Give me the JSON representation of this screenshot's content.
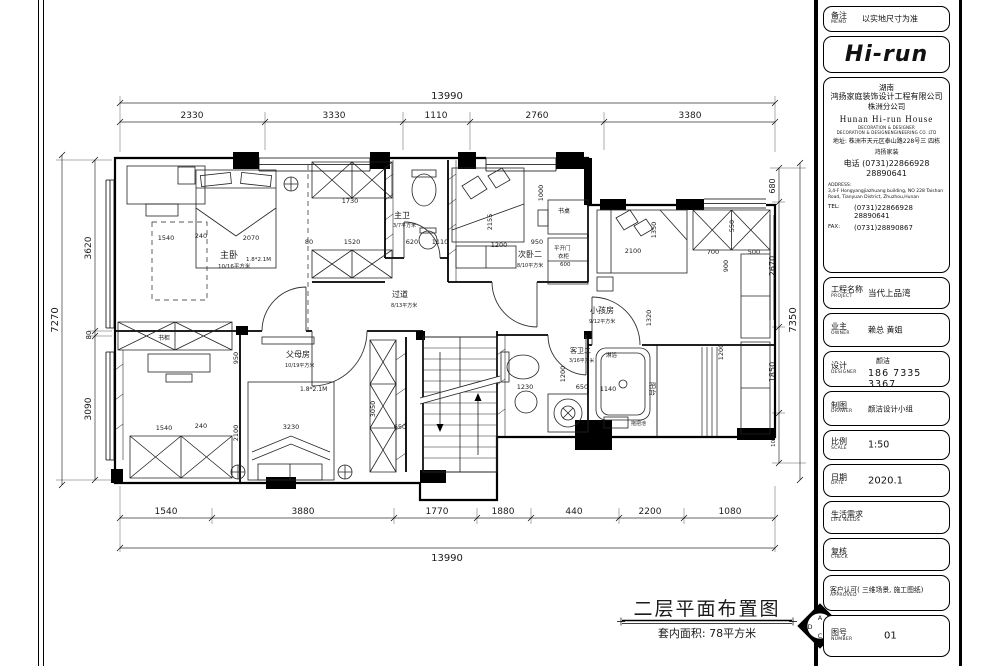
{
  "titleblock": {
    "memo": {
      "cn": "备注",
      "en": "MEMO",
      "value": "以实地尺寸为准"
    },
    "logo": "Hi-run",
    "company": {
      "region": "湖南",
      "name": "鸿扬家庭装饰设计工程有限公司",
      "branch": "株洲分公司",
      "en_name": "Hunan Hi-run House",
      "en_line1": "DECORATION & DESIGNER",
      "en_line2": "DECORATION & DESIGNENGINEERING CO. LTD",
      "addr": "地址: 株洲市天元区泰山路228号三 四栋",
      "addr2": "鸿扬家装",
      "phone": "电话  (0731)22866928",
      "phone2": "28890641",
      "en_addr_label": "ADDRESS:",
      "en_addr": "3,4-F Hongyangjiazhuang building, NO 228 Taishan Road, Tianyuan District, Zhuzhou,Hunan",
      "tel_label": "TEL:",
      "tel": "(0731)22866928\n28890641",
      "fax_label": "FAX:",
      "fax": "(0731)28890867"
    },
    "project": {
      "cn": "工程名称",
      "en": "PROJECT",
      "value": "当代上品湾"
    },
    "owner": {
      "cn": "业主",
      "en": "OWNER",
      "value": "赖总  黄姐"
    },
    "designer": {
      "cn": "设计",
      "en": "DESIGNER",
      "name": "颜洁",
      "phone": "186 7335 3367"
    },
    "drawer": {
      "cn": "制图",
      "en": "DRAWER",
      "value": "颜洁设计小组"
    },
    "scale": {
      "cn": "比例",
      "en": "SCALE",
      "value": "1:50"
    },
    "date": {
      "cn": "日期",
      "en": "DATE",
      "value": "2020.1"
    },
    "life_needs": {
      "cn": "生活需求",
      "en": "LIFE  NEEDS",
      "value": ""
    },
    "check": {
      "cn": "复核",
      "en": "CHECK",
      "value": ""
    },
    "approved": {
      "cn": "客户认可( 三维场景, 施工图纸)",
      "en": "APPROVED",
      "value": ""
    },
    "number": {
      "cn": "图号",
      "en": "NUMBER",
      "value": "01"
    }
  },
  "plan": {
    "title": "二层平面布置图",
    "subtitle": "套内面积: 78平方米",
    "compass": {
      "a": "A",
      "b": "B",
      "c": "C",
      "d": "D"
    },
    "dims": {
      "top_total": "13990",
      "top": [
        "2330",
        "3330",
        "1110",
        "2760",
        "3380"
      ],
      "bottom": [
        "1540",
        "3880",
        "1770",
        "1880",
        "440",
        "2200",
        "1080"
      ],
      "bottom_total": "13990",
      "left": [
        "3620",
        "80",
        "3090"
      ],
      "left_total": "7270",
      "right": [
        "680",
        "2670",
        "1850",
        "1070"
      ],
      "right_total": "7350"
    },
    "rooms": {
      "master": {
        "name": "主卧",
        "area": "10/16平方米",
        "bed": "1.8*2.1M"
      },
      "master_bath": {
        "name": "主卫",
        "area": "3/7平方米"
      },
      "corridor": {
        "name": "过道",
        "area": "8/13平方米"
      },
      "bedroom2": {
        "name": "次卧二",
        "area": "8/10平方米"
      },
      "kids": {
        "name": "小孩房",
        "area": "9/12平方米"
      },
      "parents": {
        "name": "父母房",
        "area": "10/19平方米",
        "bed": "1.8*2.1M"
      },
      "guest_bath": {
        "name": "客卫二",
        "area": "3/16平方米"
      }
    },
    "labels": {
      "desk": "书桌",
      "bookcase": "书柜",
      "swing_door": "平开门",
      "wardrobe": "衣柜",
      "wardrobe_w": "600",
      "shower": "淋浴",
      "balcony": "阳台",
      "mop_pool": "拖把池"
    },
    "inner_dims": [
      "1540",
      "240",
      "2070",
      "1730",
      "80",
      "1520",
      "620",
      "1110",
      "1200",
      "950",
      "1000",
      "2155",
      "2100",
      "1350",
      "550",
      "700",
      "500",
      "900",
      "1320",
      "1200",
      "950",
      "3230",
      "2100",
      "3050",
      "650",
      "1230",
      "650",
      "1140",
      "1200",
      "1540",
      "240"
    ]
  }
}
